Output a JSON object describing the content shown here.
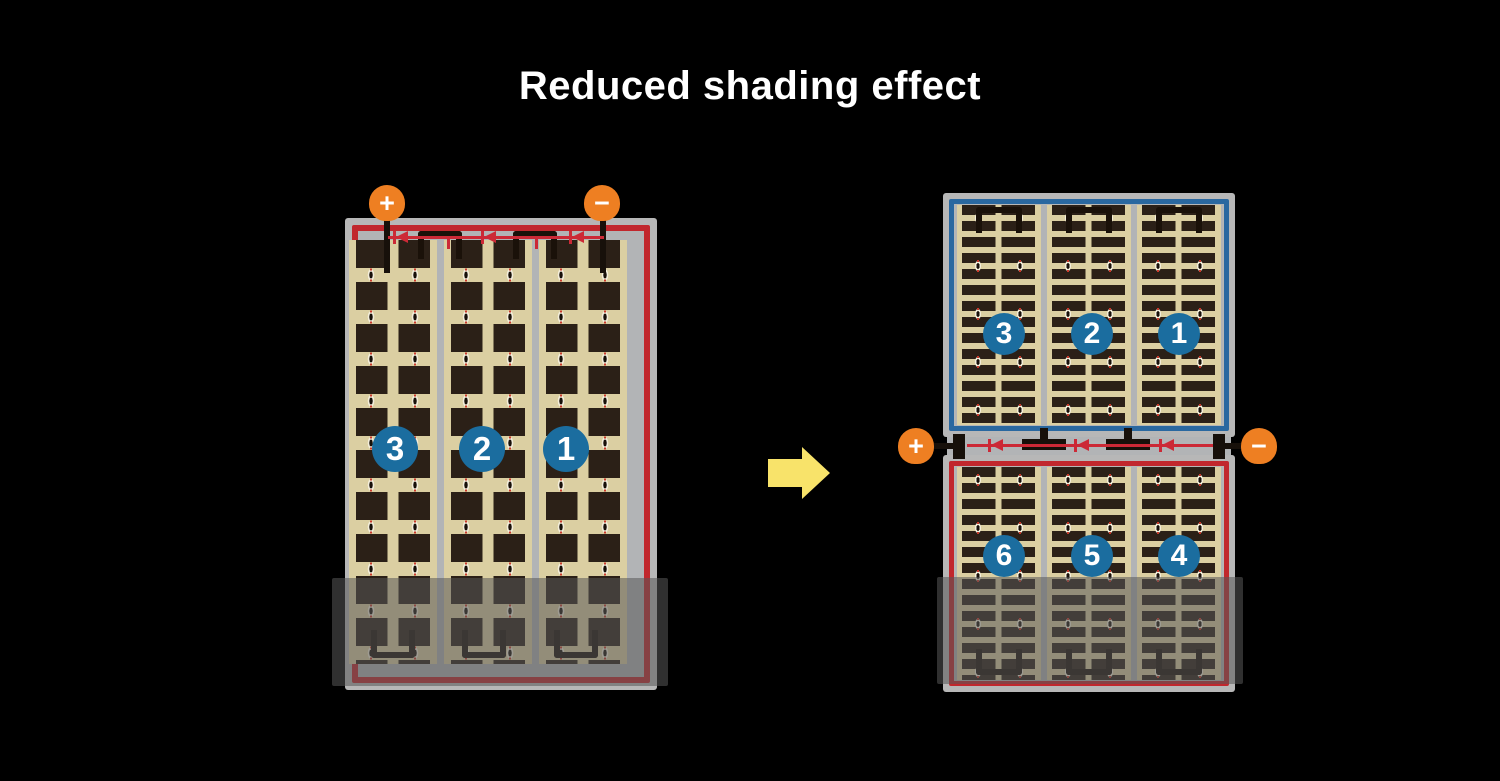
{
  "title": "Reduced shading effect",
  "left_module": {
    "terminals": {
      "positive": "+",
      "negative": "−"
    },
    "cell_strings": [
      "3",
      "2",
      "1"
    ]
  },
  "right_module": {
    "top_half": {
      "cell_strings": [
        "3",
        "2",
        "1"
      ]
    },
    "junction_terminals": {
      "positive": "+",
      "negative": "−"
    },
    "bottom_half": {
      "cell_strings": [
        "6",
        "5",
        "4"
      ]
    }
  },
  "icons": {
    "bypass_diode": "left-pointing-diode-arrow",
    "transition": "right-arrow",
    "positive_terminal": "plus-circle",
    "negative_terminal": "minus-circle"
  },
  "colors": {
    "background": "#000000",
    "frame_gray": "#b7b7b7",
    "panel_tan": "#dbcfa2",
    "cell_dark": "#2b2017",
    "border_red": "#c1272d",
    "border_blue": "#2a68a0",
    "circle_blue": "#1b6d9f",
    "terminal_orange": "#ee7f22",
    "diode_red": "#cc2936",
    "arrow_yellow": "#f8e36a",
    "shade_overlay": "rgba(88,88,88,0.55)"
  }
}
